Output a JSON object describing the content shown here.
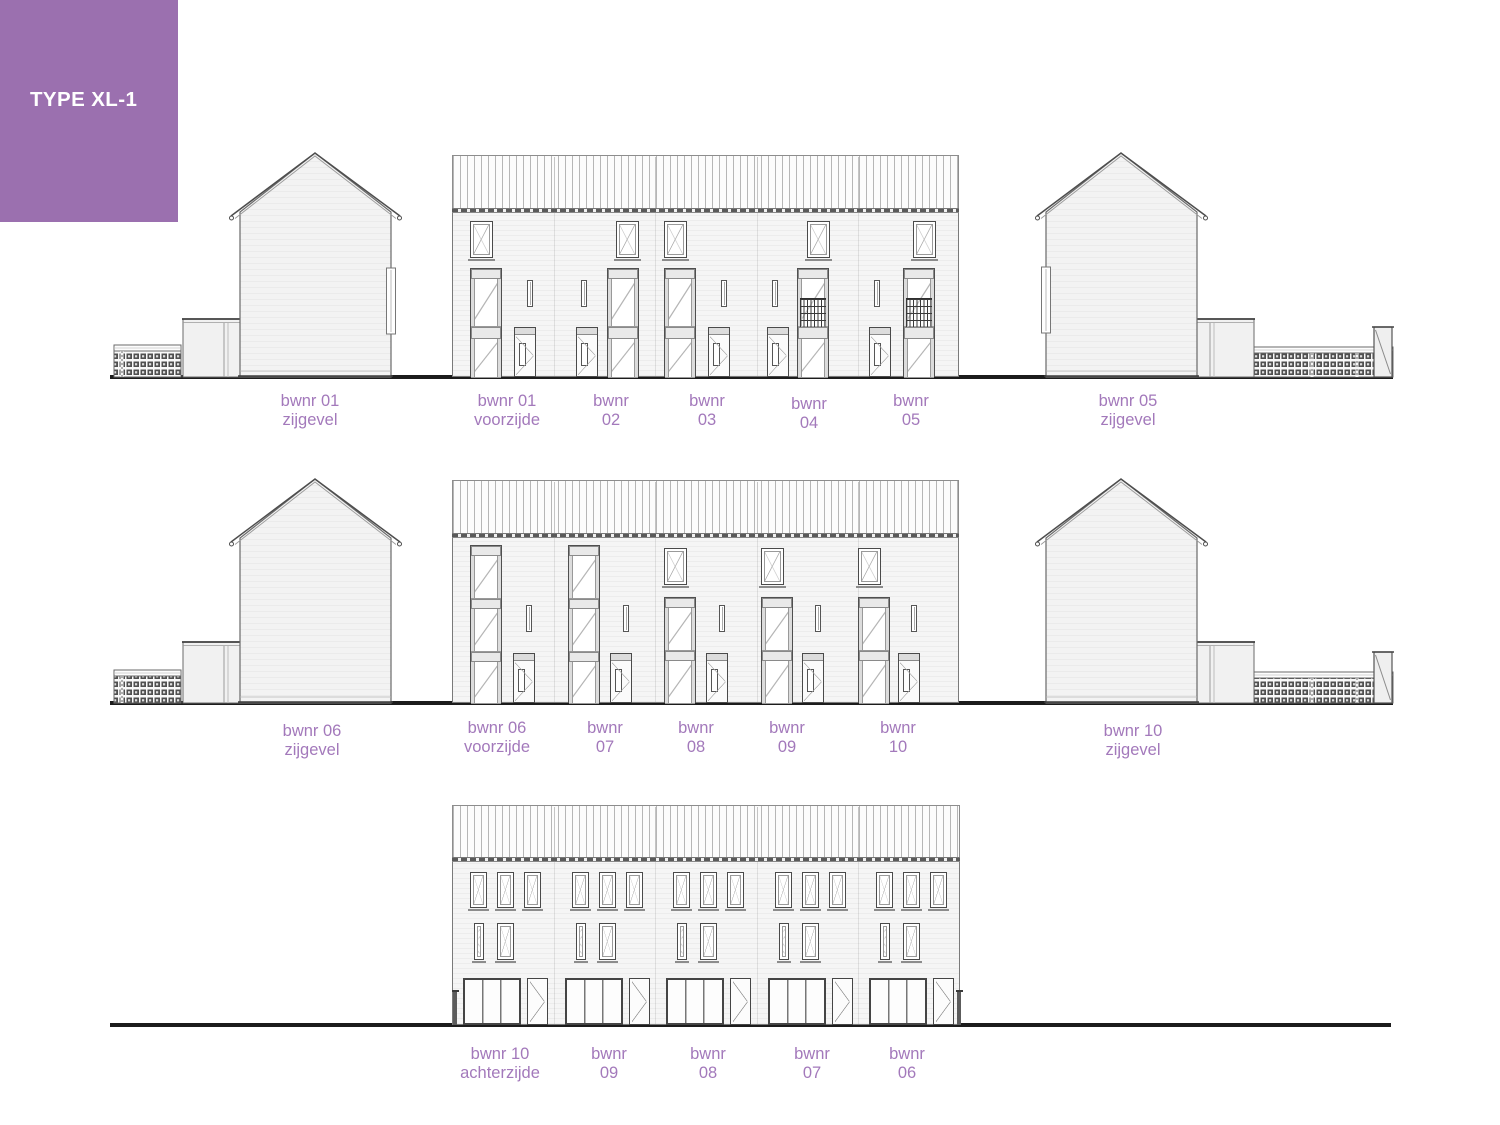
{
  "header": {
    "title": "TYPE XL-1",
    "bg": "#9b70af",
    "fg": "#ffffff"
  },
  "palette": {
    "label": "#a379bb",
    "line": "#4a4a4a",
    "ground": "#1c1c1c",
    "wall_fill": "#f4f4f4"
  },
  "labels": [
    {
      "lines": [
        "bwnr 01",
        "zijgevel"
      ],
      "x": 310,
      "y": 392
    },
    {
      "lines": [
        "bwnr 01",
        "voorzijde"
      ],
      "x": 507,
      "y": 392
    },
    {
      "lines": [
        "bwnr",
        "02"
      ],
      "x": 611,
      "y": 392
    },
    {
      "lines": [
        "bwnr",
        "03"
      ],
      "x": 707,
      "y": 392
    },
    {
      "lines": [
        "bwnr",
        "04"
      ],
      "x": 809,
      "y": 395
    },
    {
      "lines": [
        "bwnr",
        "05"
      ],
      "x": 911,
      "y": 392
    },
    {
      "lines": [
        "bwnr 05",
        "zijgevel"
      ],
      "x": 1128,
      "y": 392
    },
    {
      "lines": [
        "bwnr 06",
        "zijgevel"
      ],
      "x": 312,
      "y": 722
    },
    {
      "lines": [
        "bwnr 06",
        "voorzijde"
      ],
      "x": 497,
      "y": 719
    },
    {
      "lines": [
        "bwnr",
        "07"
      ],
      "x": 605,
      "y": 719
    },
    {
      "lines": [
        "bwnr",
        "08"
      ],
      "x": 696,
      "y": 719
    },
    {
      "lines": [
        "bwnr",
        "09"
      ],
      "x": 787,
      "y": 719
    },
    {
      "lines": [
        "bwnr",
        "10"
      ],
      "x": 898,
      "y": 719
    },
    {
      "lines": [
        "bwnr 10",
        "zijgevel"
      ],
      "x": 1133,
      "y": 722
    },
    {
      "lines": [
        "bwnr 10",
        "achterzijde"
      ],
      "x": 500,
      "y": 1045
    },
    {
      "lines": [
        "bwnr",
        "09"
      ],
      "x": 609,
      "y": 1045
    },
    {
      "lines": [
        "bwnr",
        "08"
      ],
      "x": 708,
      "y": 1045
    },
    {
      "lines": [
        "bwnr",
        "07"
      ],
      "x": 812,
      "y": 1045
    },
    {
      "lines": [
        "bwnr",
        "06"
      ],
      "x": 907,
      "y": 1045
    }
  ],
  "drawing": {
    "ground_lines": [
      {
        "x": 110,
        "y": 375,
        "w": 1283,
        "h": 4
      },
      {
        "x": 110,
        "y": 701,
        "w": 1283,
        "h": 4
      },
      {
        "x": 110,
        "y": 1023,
        "w": 1281,
        "h": 4
      }
    ],
    "fronts": [
      {
        "name": "voorzijde-01-05",
        "x": 452,
        "w": 507,
        "bandTop": 155,
        "bandBot": 208,
        "baseY": 377,
        "dividers": [
          553.5,
          655,
          756.5,
          858
        ],
        "features": [
          {
            "t": "topwin",
            "x": 470,
            "y": 221,
            "w": 23,
            "h": 37
          },
          {
            "t": "stack2",
            "x": 470,
            "y": 268,
            "w": 32,
            "h": 109
          },
          {
            "t": "slit",
            "x": 527,
            "y": 280,
            "w": 6,
            "h": 27
          },
          {
            "t": "door",
            "x": 514,
            "y": 327,
            "w": 22,
            "h": 50
          },
          {
            "t": "slit",
            "x": 581,
            "y": 280,
            "w": 6,
            "h": 27
          },
          {
            "t": "door",
            "x": 576,
            "y": 327,
            "w": 22,
            "h": 50
          },
          {
            "t": "stack2",
            "x": 607,
            "y": 268,
            "w": 32,
            "h": 109
          },
          {
            "t": "topwin",
            "x": 616,
            "y": 221,
            "w": 23,
            "h": 37
          },
          {
            "t": "topwin",
            "x": 664,
            "y": 221,
            "w": 23,
            "h": 37
          },
          {
            "t": "stack2",
            "x": 664,
            "y": 268,
            "w": 32,
            "h": 109
          },
          {
            "t": "slit",
            "x": 721,
            "y": 280,
            "w": 6,
            "h": 27
          },
          {
            "t": "door",
            "x": 708,
            "y": 327,
            "w": 22,
            "h": 50
          },
          {
            "t": "slit",
            "x": 772,
            "y": 280,
            "w": 6,
            "h": 27
          },
          {
            "t": "door",
            "x": 767,
            "y": 327,
            "w": 22,
            "h": 50
          },
          {
            "t": "stack2b",
            "x": 797,
            "y": 268,
            "w": 32,
            "h": 109
          },
          {
            "t": "topwin",
            "x": 807,
            "y": 221,
            "w": 23,
            "h": 37
          },
          {
            "t": "slit",
            "x": 874,
            "y": 280,
            "w": 6,
            "h": 27
          },
          {
            "t": "door",
            "x": 869,
            "y": 327,
            "w": 22,
            "h": 50
          },
          {
            "t": "stack2b",
            "x": 903,
            "y": 268,
            "w": 32,
            "h": 109
          },
          {
            "t": "topwin",
            "x": 913,
            "y": 221,
            "w": 23,
            "h": 37
          }
        ]
      },
      {
        "name": "voorzijde-06-10",
        "x": 452,
        "w": 507,
        "bandTop": 480,
        "bandBot": 533,
        "baseY": 703,
        "dividers": [
          553.5,
          655,
          756.5,
          858
        ],
        "features": [
          {
            "t": "stack3",
            "x": 470,
            "y": 545,
            "w": 32,
            "h": 158
          },
          {
            "t": "slit",
            "x": 526,
            "y": 605,
            "w": 6,
            "h": 27
          },
          {
            "t": "door",
            "x": 513,
            "y": 653,
            "w": 22,
            "h": 50
          },
          {
            "t": "stack3",
            "x": 568,
            "y": 545,
            "w": 32,
            "h": 158
          },
          {
            "t": "slit",
            "x": 623,
            "y": 605,
            "w": 6,
            "h": 27
          },
          {
            "t": "door",
            "x": 610,
            "y": 653,
            "w": 22,
            "h": 50
          },
          {
            "t": "topwin",
            "x": 664,
            "y": 548,
            "w": 23,
            "h": 37
          },
          {
            "t": "stack2r",
            "x": 664,
            "y": 597,
            "w": 32,
            "h": 106
          },
          {
            "t": "slit",
            "x": 719,
            "y": 605,
            "w": 6,
            "h": 27
          },
          {
            "t": "door",
            "x": 706,
            "y": 653,
            "w": 22,
            "h": 50
          },
          {
            "t": "topwin",
            "x": 761,
            "y": 548,
            "w": 23,
            "h": 37
          },
          {
            "t": "stack2r",
            "x": 761,
            "y": 597,
            "w": 32,
            "h": 106
          },
          {
            "t": "slit",
            "x": 815,
            "y": 605,
            "w": 6,
            "h": 27
          },
          {
            "t": "door",
            "x": 802,
            "y": 653,
            "w": 22,
            "h": 50
          },
          {
            "t": "topwin",
            "x": 858,
            "y": 548,
            "w": 23,
            "h": 37
          },
          {
            "t": "stack2r",
            "x": 858,
            "y": 597,
            "w": 32,
            "h": 106
          },
          {
            "t": "slit",
            "x": 911,
            "y": 605,
            "w": 6,
            "h": 27
          },
          {
            "t": "door",
            "x": 898,
            "y": 653,
            "w": 22,
            "h": 50
          }
        ]
      },
      {
        "name": "achterzijde-10-06",
        "x": 452,
        "w": 508,
        "bandTop": 805,
        "bandBot": 857,
        "baseY": 1025,
        "dividers": [
          553.5,
          655,
          756.5,
          858
        ],
        "features": [
          {
            "t": "topwin",
            "x": 470,
            "y": 872,
            "w": 17,
            "h": 36
          },
          {
            "t": "topwin",
            "x": 497,
            "y": 872,
            "w": 17,
            "h": 36
          },
          {
            "t": "topwin",
            "x": 524,
            "y": 872,
            "w": 17,
            "h": 36
          },
          {
            "t": "topwin",
            "x": 572,
            "y": 872,
            "w": 17,
            "h": 36
          },
          {
            "t": "topwin",
            "x": 599,
            "y": 872,
            "w": 17,
            "h": 36
          },
          {
            "t": "topwin",
            "x": 626,
            "y": 872,
            "w": 17,
            "h": 36
          },
          {
            "t": "topwin",
            "x": 673,
            "y": 872,
            "w": 17,
            "h": 36
          },
          {
            "t": "topwin",
            "x": 700,
            "y": 872,
            "w": 17,
            "h": 36
          },
          {
            "t": "topwin",
            "x": 727,
            "y": 872,
            "w": 17,
            "h": 36
          },
          {
            "t": "topwin",
            "x": 775,
            "y": 872,
            "w": 17,
            "h": 36
          },
          {
            "t": "topwin",
            "x": 802,
            "y": 872,
            "w": 17,
            "h": 36
          },
          {
            "t": "topwin",
            "x": 829,
            "y": 872,
            "w": 17,
            "h": 36
          },
          {
            "t": "topwin",
            "x": 876,
            "y": 872,
            "w": 17,
            "h": 36
          },
          {
            "t": "topwin",
            "x": 903,
            "y": 872,
            "w": 17,
            "h": 36
          },
          {
            "t": "topwin",
            "x": 930,
            "y": 872,
            "w": 17,
            "h": 36
          },
          {
            "t": "topwin",
            "x": 474,
            "y": 923,
            "w": 10,
            "h": 37
          },
          {
            "t": "topwin",
            "x": 497,
            "y": 923,
            "w": 17,
            "h": 37
          },
          {
            "t": "topwin",
            "x": 576,
            "y": 923,
            "w": 10,
            "h": 37
          },
          {
            "t": "topwin",
            "x": 599,
            "y": 923,
            "w": 17,
            "h": 37
          },
          {
            "t": "topwin",
            "x": 677,
            "y": 923,
            "w": 10,
            "h": 37
          },
          {
            "t": "topwin",
            "x": 700,
            "y": 923,
            "w": 17,
            "h": 37
          },
          {
            "t": "topwin",
            "x": 779,
            "y": 923,
            "w": 10,
            "h": 37
          },
          {
            "t": "topwin",
            "x": 802,
            "y": 923,
            "w": 17,
            "h": 37
          },
          {
            "t": "topwin",
            "x": 880,
            "y": 923,
            "w": 10,
            "h": 37
          },
          {
            "t": "topwin",
            "x": 903,
            "y": 923,
            "w": 17,
            "h": 37
          },
          {
            "t": "patio",
            "x": 463,
            "y": 978,
            "w": 58,
            "h": 47
          },
          {
            "t": "rdoor",
            "x": 527,
            "y": 978,
            "w": 21,
            "h": 47
          },
          {
            "t": "patio",
            "x": 565,
            "y": 978,
            "w": 58,
            "h": 47
          },
          {
            "t": "rdoor",
            "x": 629,
            "y": 978,
            "w": 21,
            "h": 47
          },
          {
            "t": "patio",
            "x": 666,
            "y": 978,
            "w": 58,
            "h": 47
          },
          {
            "t": "rdoor",
            "x": 730,
            "y": 978,
            "w": 21,
            "h": 47
          },
          {
            "t": "patio",
            "x": 768,
            "y": 978,
            "w": 58,
            "h": 47
          },
          {
            "t": "rdoor",
            "x": 832,
            "y": 978,
            "w": 21,
            "h": 47
          },
          {
            "t": "patio",
            "x": 869,
            "y": 978,
            "w": 58,
            "h": 47
          },
          {
            "t": "rdoor",
            "x": 933,
            "y": 978,
            "w": 21,
            "h": 47
          },
          {
            "t": "post",
            "x": 453,
            "y": 992,
            "w": 4,
            "h": 33
          },
          {
            "t": "post",
            "x": 957,
            "y": 992,
            "w": 4,
            "h": 33
          }
        ]
      }
    ],
    "sides": [
      {
        "name": "bwnr01-zijgevel",
        "wl": 240,
        "wr": 391,
        "apex": 315,
        "apexY": 153,
        "eavesY": 212,
        "baseY": 377,
        "garage": {
          "x": 183,
          "w": 57,
          "top": 319,
          "seam": 224
        },
        "fence": {
          "x": 114,
          "w": 67,
          "top": 345,
          "divs": [
            122
          ]
        },
        "strip": {
          "side": "right",
          "y": 268,
          "h": 66
        },
        "box": [
          103,
          140,
          302,
          242
        ]
      },
      {
        "name": "bwnr05-zijgevel",
        "wl": 1046,
        "wr": 1197,
        "apex": 1121,
        "apexY": 153,
        "eavesY": 212,
        "baseY": 377,
        "garage": {
          "x": 1197,
          "w": 57,
          "top": 319,
          "seam": 1210
        },
        "fence": {
          "x": 1254,
          "w": 139,
          "top": 347,
          "divs": [
            1312,
            1357
          ]
        },
        "gate": {
          "x": 1374,
          "w": 18,
          "top": 327
        },
        "strip": {
          "side": "left",
          "y": 267,
          "h": 66
        },
        "box": [
          1033,
          140,
          367,
          242
        ]
      },
      {
        "name": "bwnr06-zijgevel",
        "wl": 240,
        "wr": 391,
        "apex": 315,
        "apexY": 479,
        "eavesY": 538,
        "baseY": 703,
        "garage": {
          "x": 183,
          "w": 57,
          "top": 642,
          "seam": 224
        },
        "fence": {
          "x": 114,
          "w": 67,
          "top": 670,
          "divs": [
            122
          ]
        },
        "box": [
          103,
          466,
          302,
          242
        ]
      },
      {
        "name": "bwnr10-zijgevel",
        "wl": 1046,
        "wr": 1197,
        "apex": 1121,
        "apexY": 479,
        "eavesY": 538,
        "baseY": 703,
        "garage": {
          "x": 1197,
          "w": 57,
          "top": 642,
          "seam": 1210
        },
        "fence": {
          "x": 1254,
          "w": 139,
          "top": 672,
          "divs": [
            1312,
            1357
          ]
        },
        "gate": {
          "x": 1374,
          "w": 18,
          "top": 652
        },
        "box": [
          1033,
          466,
          367,
          242
        ]
      }
    ]
  }
}
